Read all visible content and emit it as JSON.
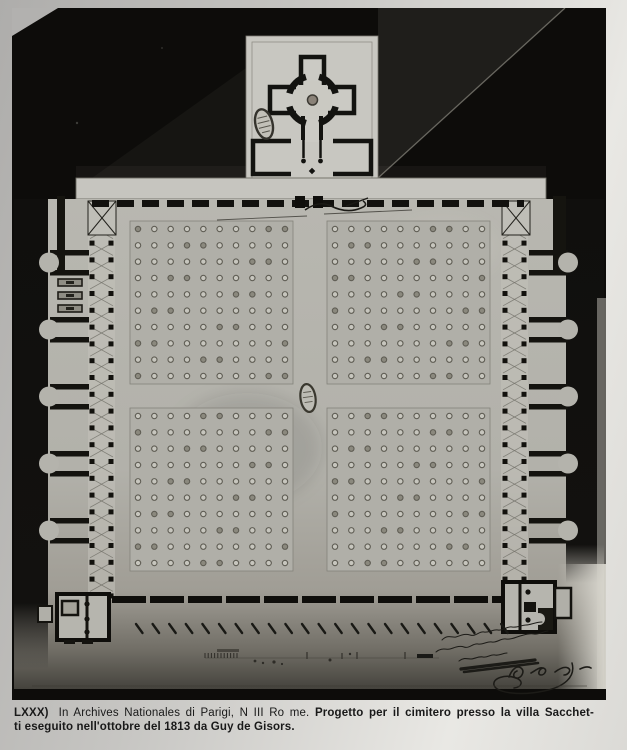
{
  "caption": {
    "reference": "LXXX)",
    "archive": "In Archives Nationales di Parigi, N III Ro me.",
    "title_line1": "Progetto per il cimitero presso la villa Sacchet-",
    "title_line2": "ti eseguito nell'ottobre del 1813 da Guy de Gisors."
  },
  "inscription": {
    "description": "illegible handwritten dedication in ink, lower right of drawing",
    "date": "8bre 1813",
    "signature": "Gisors"
  },
  "colors": {
    "page": "#c6c5c2",
    "photo_black": "#0d0c0a",
    "paper_light": "#c8c7c1",
    "paper_field": "#b3b2ab",
    "ink": "#131310"
  },
  "plan": {
    "quadrants": [
      {
        "x": 118,
        "y": 213
      },
      {
        "x": 315,
        "y": 213
      },
      {
        "x": 118,
        "y": 400
      },
      {
        "x": 315,
        "y": 400
      }
    ],
    "quadrant_size": 163,
    "rows": 10,
    "cols": 10,
    "colonnades": [
      {
        "x": 76,
        "w": 27
      },
      {
        "x": 489,
        "w": 27
      }
    ],
    "columns_y_start": 199,
    "columns_y_end": 586,
    "columns_step": 16.8,
    "column_size": 5,
    "chamber_bar_pairs_y": [
      242,
      309,
      376,
      443,
      510
    ],
    "pair_gap": 20,
    "bar_h": 5.5,
    "bar_w": 39,
    "chamber_left_x": 38,
    "chamber_right_x": 517,
    "niche_centers_y": [
      254.5,
      321.5,
      388.5,
      455.5,
      522.5
    ],
    "monuments_y": [
      271,
      284,
      297
    ],
    "avenue_ticks": {
      "count": 23,
      "x0": 124,
      "step": 16.6,
      "y": 616
    },
    "scale_ticks": {
      "x0": 193,
      "count": 11,
      "step": 3.2,
      "y": 650
    }
  }
}
